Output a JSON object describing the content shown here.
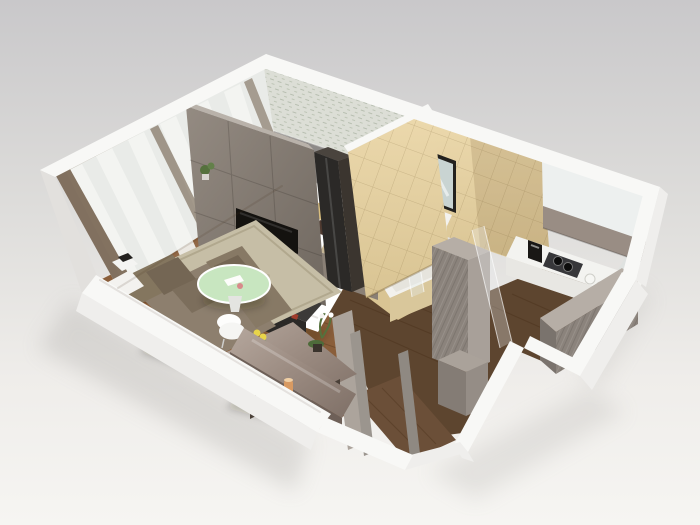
{
  "scene": {
    "description": "3D isometric cutaway rendering of a one-bedroom apartment floor plan, viewed from above on a neutral gray studio background",
    "view": "isometric-top-down",
    "background_style": "gray gradient, light at bottom",
    "rooms": [
      {
        "id": "living-room",
        "floor": "warm wood planks",
        "features": [
          "corner sofa",
          "round glass coffee table",
          "area rug",
          "tv panel wall",
          "tv stand",
          "dining table",
          "two shell chairs",
          "sideboard",
          "sheer curtained window wall",
          "laptop side table"
        ]
      },
      {
        "id": "bedroom",
        "floor": "warm wood planks",
        "features": [
          "double bed with white duvet",
          "white and yellow pillows",
          "brown accent pillow",
          "gray padded headboard wall",
          "patterned wallpaper",
          "nightstand with ball lamp",
          "dark wardrobe",
          "storage bench"
        ]
      },
      {
        "id": "bathroom",
        "floor": "beige tile",
        "features": [
          "beige tiled walls",
          "framed mirror",
          "white vanity sink",
          "wall-hung toilet",
          "bathtub",
          "glass shower screen"
        ]
      },
      {
        "id": "kitchen",
        "floor": "dark wood",
        "features": [
          "white walls",
          "taupe upper cabinet band",
          "white countertop",
          "gas hob",
          "coffee machine",
          "sink",
          "gray wood-grain bar counter",
          "glass partition"
        ]
      },
      {
        "id": "hallway",
        "floor": "dark wood planks",
        "features": [
          "gray wardrobe cabinets",
          "door frame",
          "entrance porch",
          "orchid on sideboard",
          "candle holder",
          "wine glass"
        ]
      }
    ]
  },
  "palette": {
    "bg-top": "#c9c8ca",
    "bg-mid": "#dddcda",
    "bg-bottom": "#f6f5f2",
    "wall-top": "#f8f8f6",
    "wall-face": "#efeeec",
    "wall-shade": "#e2e0dd",
    "wood": "#8a5e3a",
    "wood-light": "#a3774a",
    "wood-dark": "#5d452f",
    "porch-wood": "#6b4f38",
    "curtain": "#e9ebe8",
    "curtain-hi": "#f5f6f3",
    "mullion": "#6e5b47",
    "wallpaper": "#dcded6",
    "headboard": "#8e8b89",
    "panel": "#8b8279",
    "panel-dark": "#6f675f",
    "charcoal": "#2b2927",
    "tv-black": "#14120f",
    "duvet": "#ffffff",
    "linen-shadow": "#dbd9d4",
    "pillow-yellow": "#d9be7e",
    "pillow-brown": "#4f3a30",
    "sofa": "#8d7f6e",
    "sofa-dark": "#746654",
    "rug": "#c6bea6",
    "rug-dark": "#b1a88e",
    "glass-green": "#c8e6c0",
    "dining": "#9a8a80",
    "gloss": "#b5a79d",
    "white-chair": "#f5f5f3",
    "tile": "#d9c493",
    "tile-dark": "#c6b184",
    "tile-light": "#ecd9ad",
    "cab-gray": "#8b837c",
    "cab-gray-light": "#a8a099",
    "cab-top": "#b6aea6",
    "taupe-band": "#998d84",
    "counter": "#f3f3f0",
    "steel": "#37373a",
    "plant": "#55713d",
    "flower": "#e8d44a",
    "candle": "#d89a62",
    "shadow": "#a3a09d"
  }
}
